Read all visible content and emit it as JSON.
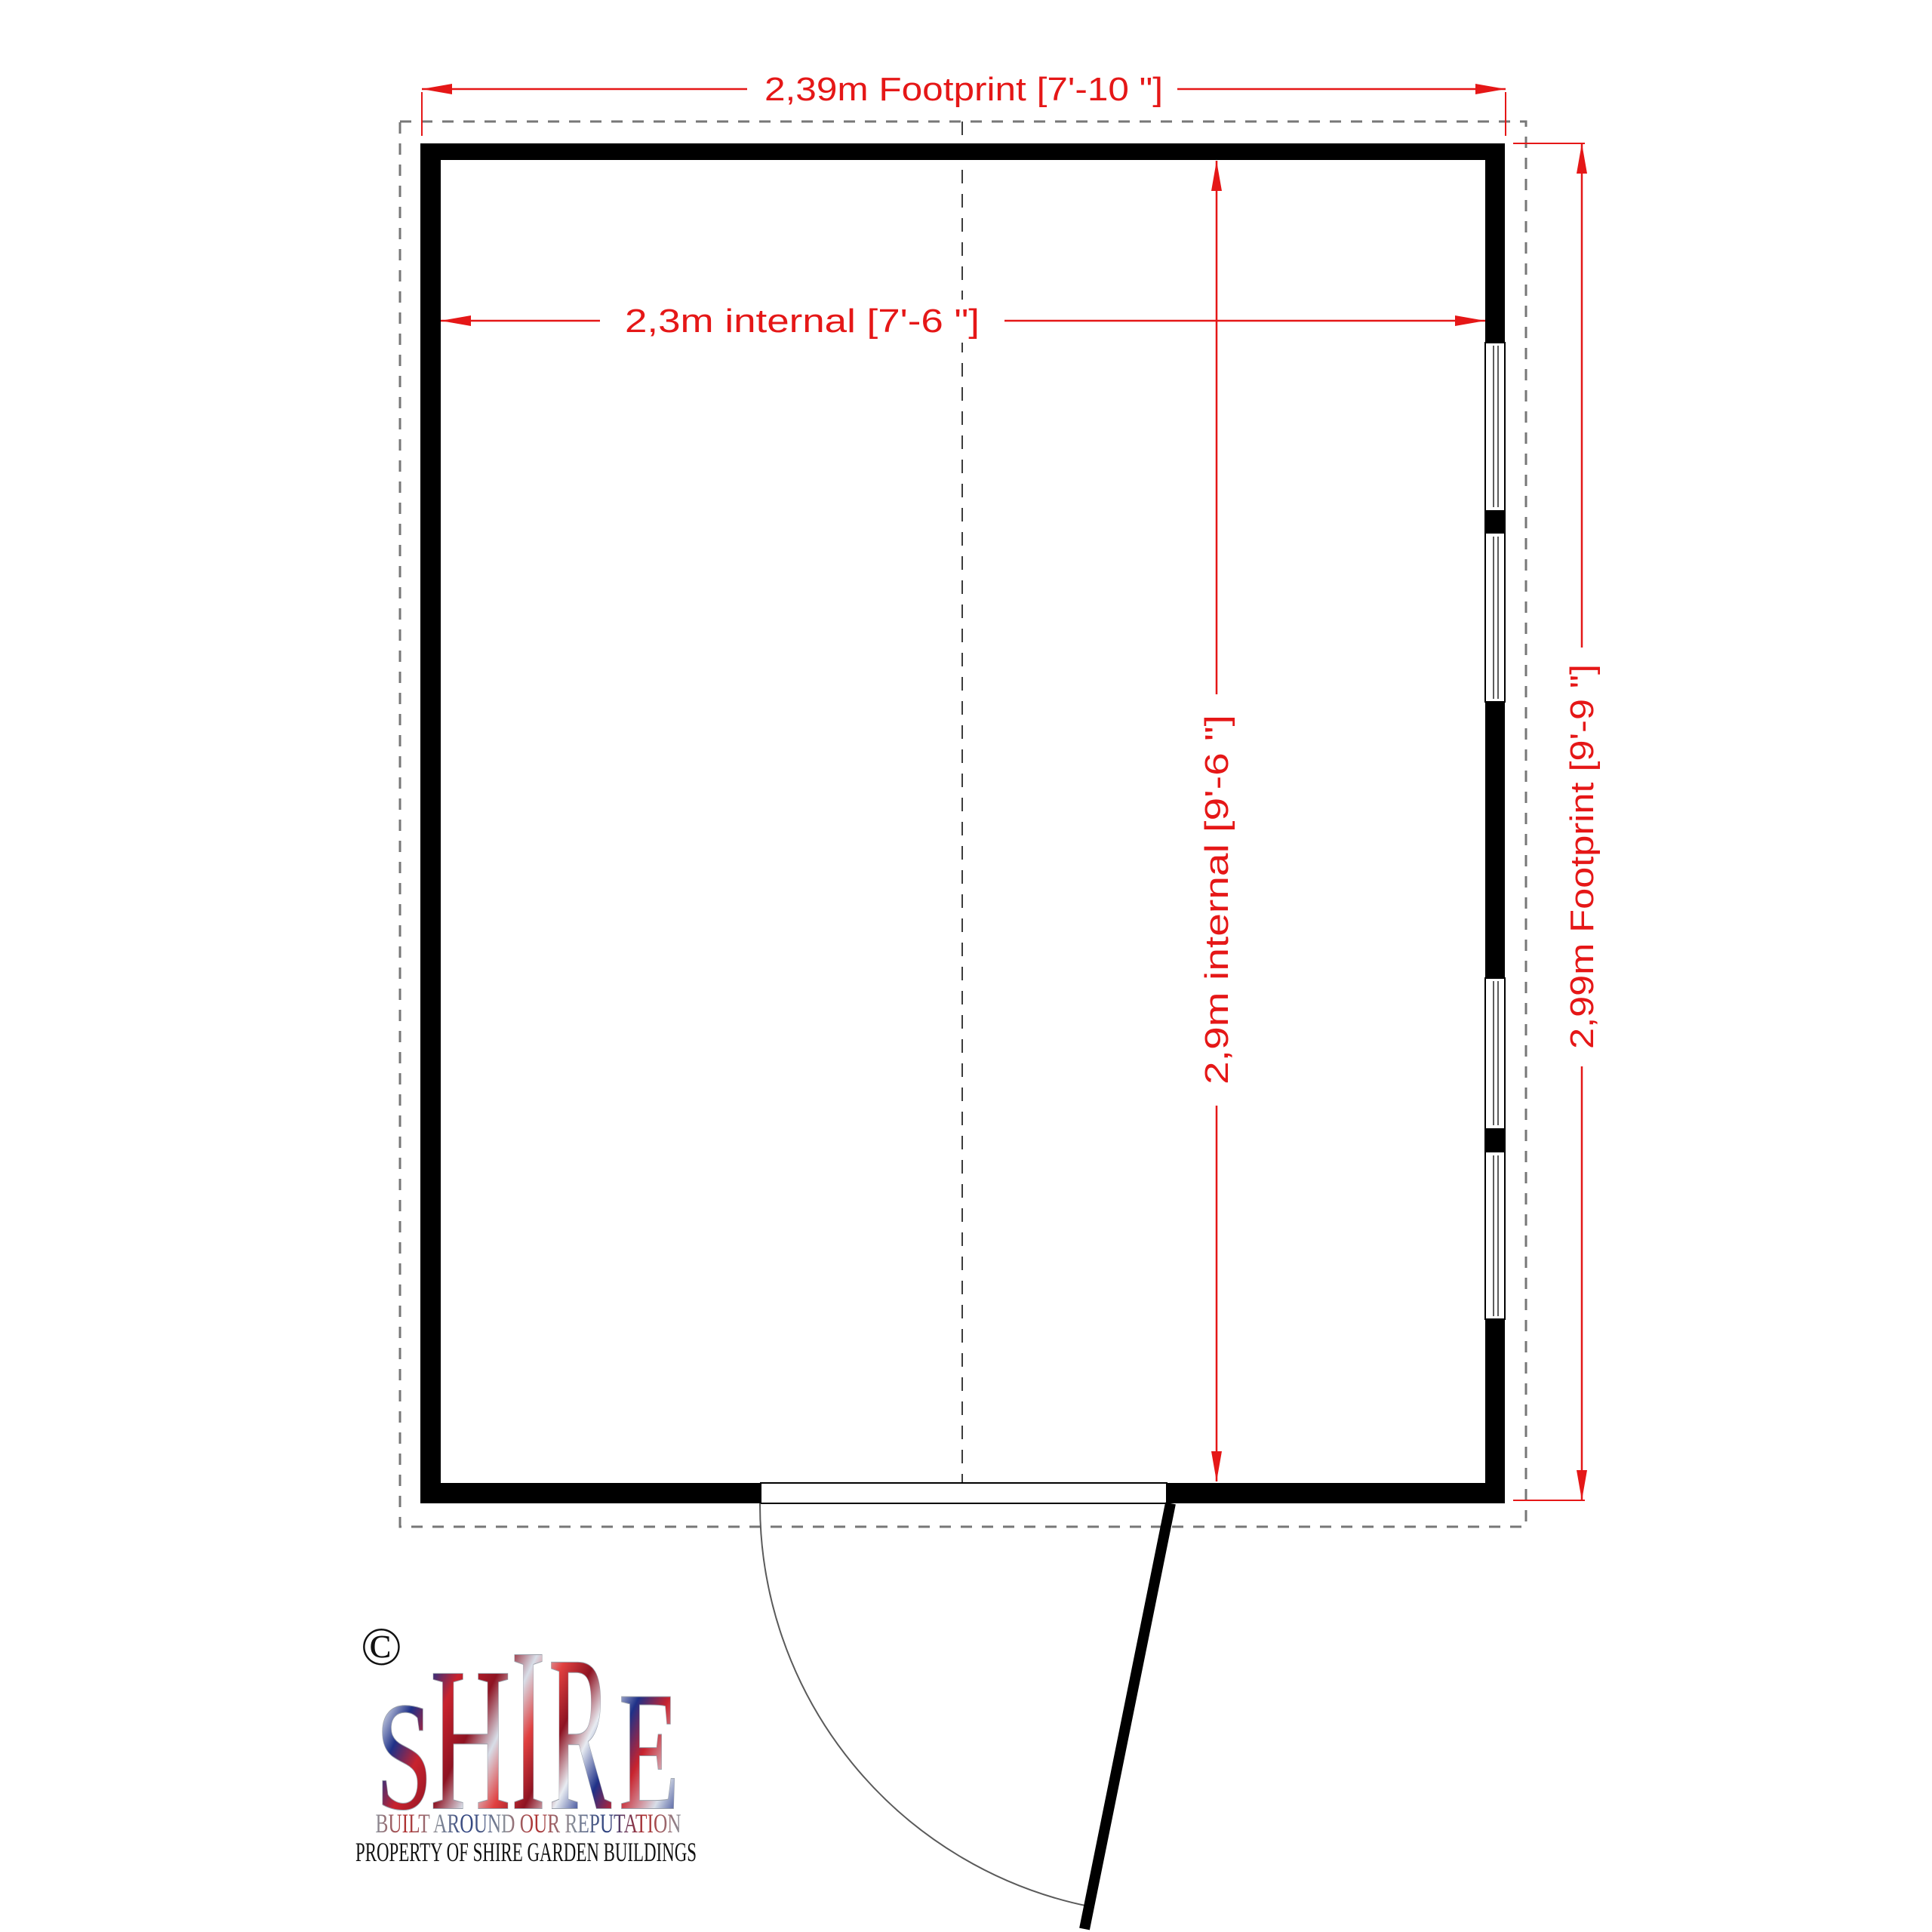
{
  "colors": {
    "dimension_red": "#e51717",
    "wall_black": "#000000",
    "footprint_dash": "#777777",
    "centerline": "#3c3c3c",
    "glazing": "#4a4a4a",
    "door_arc": "#5a5a5a",
    "property_text": "#111111",
    "logo_red": "#c8232e",
    "logo_dark_red": "#8e1322",
    "logo_blue": "#1f3188",
    "logo_silver": "#d8dee8"
  },
  "plan": {
    "dimensions": {
      "footprint_width": "2,39m Footprint [7'-10 \"]",
      "internal_width": "2,3m internal  [7'-6 \"]",
      "internal_depth": "2,9m internal  [9'-6 \"]",
      "footprint_depth": "2,99m Footprint [9'-9 \"]"
    }
  },
  "logo": {
    "copyright_symbol": "©",
    "brand_letters": [
      {
        "char": "S"
      },
      {
        "char": "H"
      },
      {
        "char": "I"
      },
      {
        "char": "R"
      },
      {
        "char": "E"
      }
    ],
    "tagline": "BUILT AROUND OUR REPUTATION",
    "property_line": "PROPERTY OF SHIRE GARDEN BUILDINGS"
  }
}
